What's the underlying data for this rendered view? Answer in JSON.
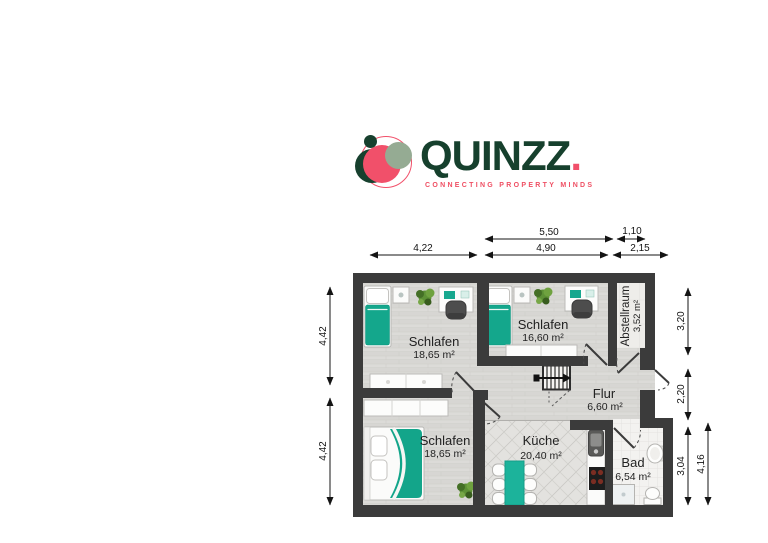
{
  "logo": {
    "brand": "QUINZZ",
    "brand_dot": ".",
    "tagline": "CONNECTING PROPERTY MINDS",
    "colors": {
      "green": "#16402d",
      "pink": "#f1506a",
      "sage": "#95ab93"
    }
  },
  "floorplan": {
    "rooms": [
      {
        "id": "schlafen-top-left",
        "name": "Schlafen",
        "area": "18,65 m²"
      },
      {
        "id": "schlafen-top-mid",
        "name": "Schlafen",
        "area": "16,60 m²"
      },
      {
        "id": "abstellraum",
        "name": "Abstellraum",
        "area": "3,52 m²"
      },
      {
        "id": "flur",
        "name": "Flur",
        "area": "6,60 m²"
      },
      {
        "id": "schlafen-bottom",
        "name": "Schlafen",
        "area": "18,65 m²"
      },
      {
        "id": "kueche",
        "name": "Küche",
        "area": "20,40 m²"
      },
      {
        "id": "bad",
        "name": "Bad",
        "area": "6,54 m²"
      }
    ],
    "dimensions": {
      "top": [
        {
          "label": "4,22"
        },
        {
          "label": "5,50"
        },
        {
          "label": "4,90"
        },
        {
          "label": "1,10"
        },
        {
          "label": "2,15"
        }
      ],
      "left": [
        {
          "label": "4,42"
        },
        {
          "label": "4,42"
        }
      ],
      "right": [
        {
          "label": "3,20"
        },
        {
          "label": "2,20"
        },
        {
          "label": "3,04"
        },
        {
          "label": "4,16"
        }
      ]
    },
    "colors": {
      "wall": "#3b3b3b",
      "accent_teal": "#14a78c",
      "floor_wood": "#dcdbd8"
    }
  }
}
